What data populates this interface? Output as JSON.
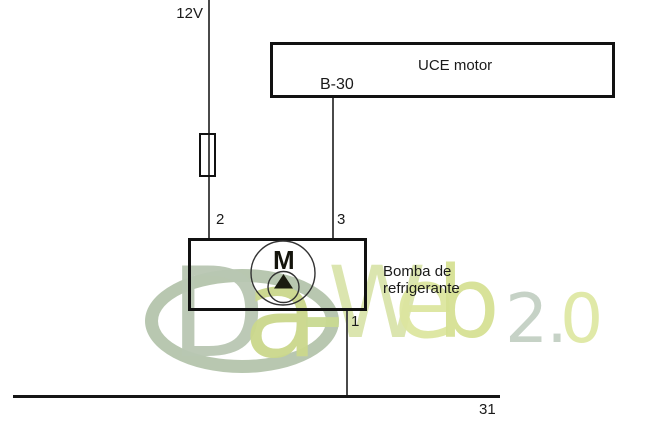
{
  "labels": {
    "supply": "12V",
    "pin2": "2",
    "pin3": "3",
    "pin1": "1",
    "ground": "31"
  },
  "uce": {
    "title": "UCE motor",
    "pin": "B-30"
  },
  "pump": {
    "motor_symbol": "M",
    "name_line1": "Bomba de",
    "name_line2": "refrigerante"
  },
  "watermark": {
    "d": "D",
    "a": "a",
    "hyphen": "-",
    "w": "W",
    "e": "e",
    "b": "b",
    "version_2dot": "2.",
    "version_0": "0"
  },
  "colors": {
    "wire": "#4a4a4a",
    "outline": "#111111",
    "watermark_sage": "#b9c7b3",
    "watermark_green": "#cbd88c",
    "watermark_pale": "#dde6a0",
    "watermark_version": "#c3d0c4"
  }
}
